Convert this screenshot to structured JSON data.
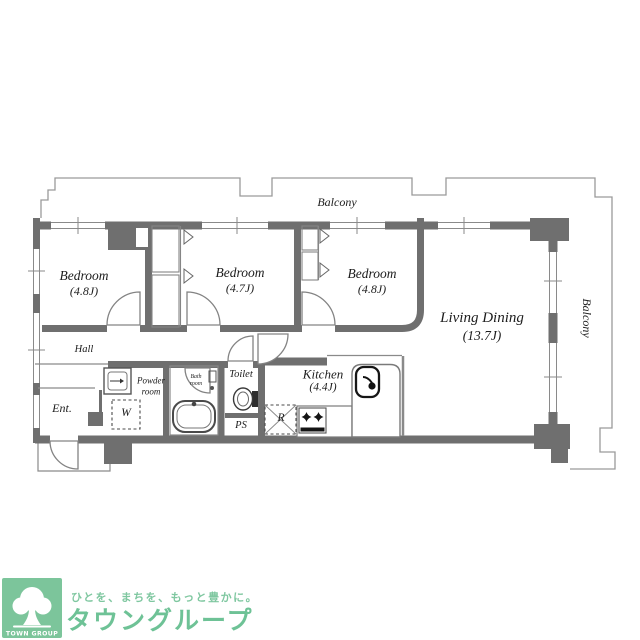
{
  "floorplan": {
    "balcony_top": "Balcony",
    "balcony_right": "Balcony",
    "bedroom1": {
      "name": "Bedroom",
      "size": "(4.8J)"
    },
    "bedroom2": {
      "name": "Bedroom",
      "size": "(4.7J)"
    },
    "bedroom3": {
      "name": "Bedroom",
      "size": "(4.8J)"
    },
    "living_dining": {
      "name": "Living Dining",
      "size": "(13.7J)"
    },
    "kitchen": {
      "name": "Kitchen",
      "size": "(4.4J)"
    },
    "hall": "Hall",
    "entrance": "Ent.",
    "powder_room": {
      "line1": "Powder",
      "line2": "room"
    },
    "bath_room": {
      "line1": "Bath",
      "line2": "room"
    },
    "toilet": "Toilet",
    "pipe_space": "PS",
    "washer_place": "W",
    "refrigerator_place": "R"
  },
  "logo": {
    "tagline": "ひとを、まちを、もっと豊かに。",
    "brand": "タウングループ",
    "badge": "TOWN GROUP"
  },
  "colors": {
    "wall": "#6f6f6f",
    "thin_line": "#8a8a8a",
    "logo_green": "#7cc59b",
    "brand_green": "#6ec296",
    "background": "#ffffff"
  }
}
